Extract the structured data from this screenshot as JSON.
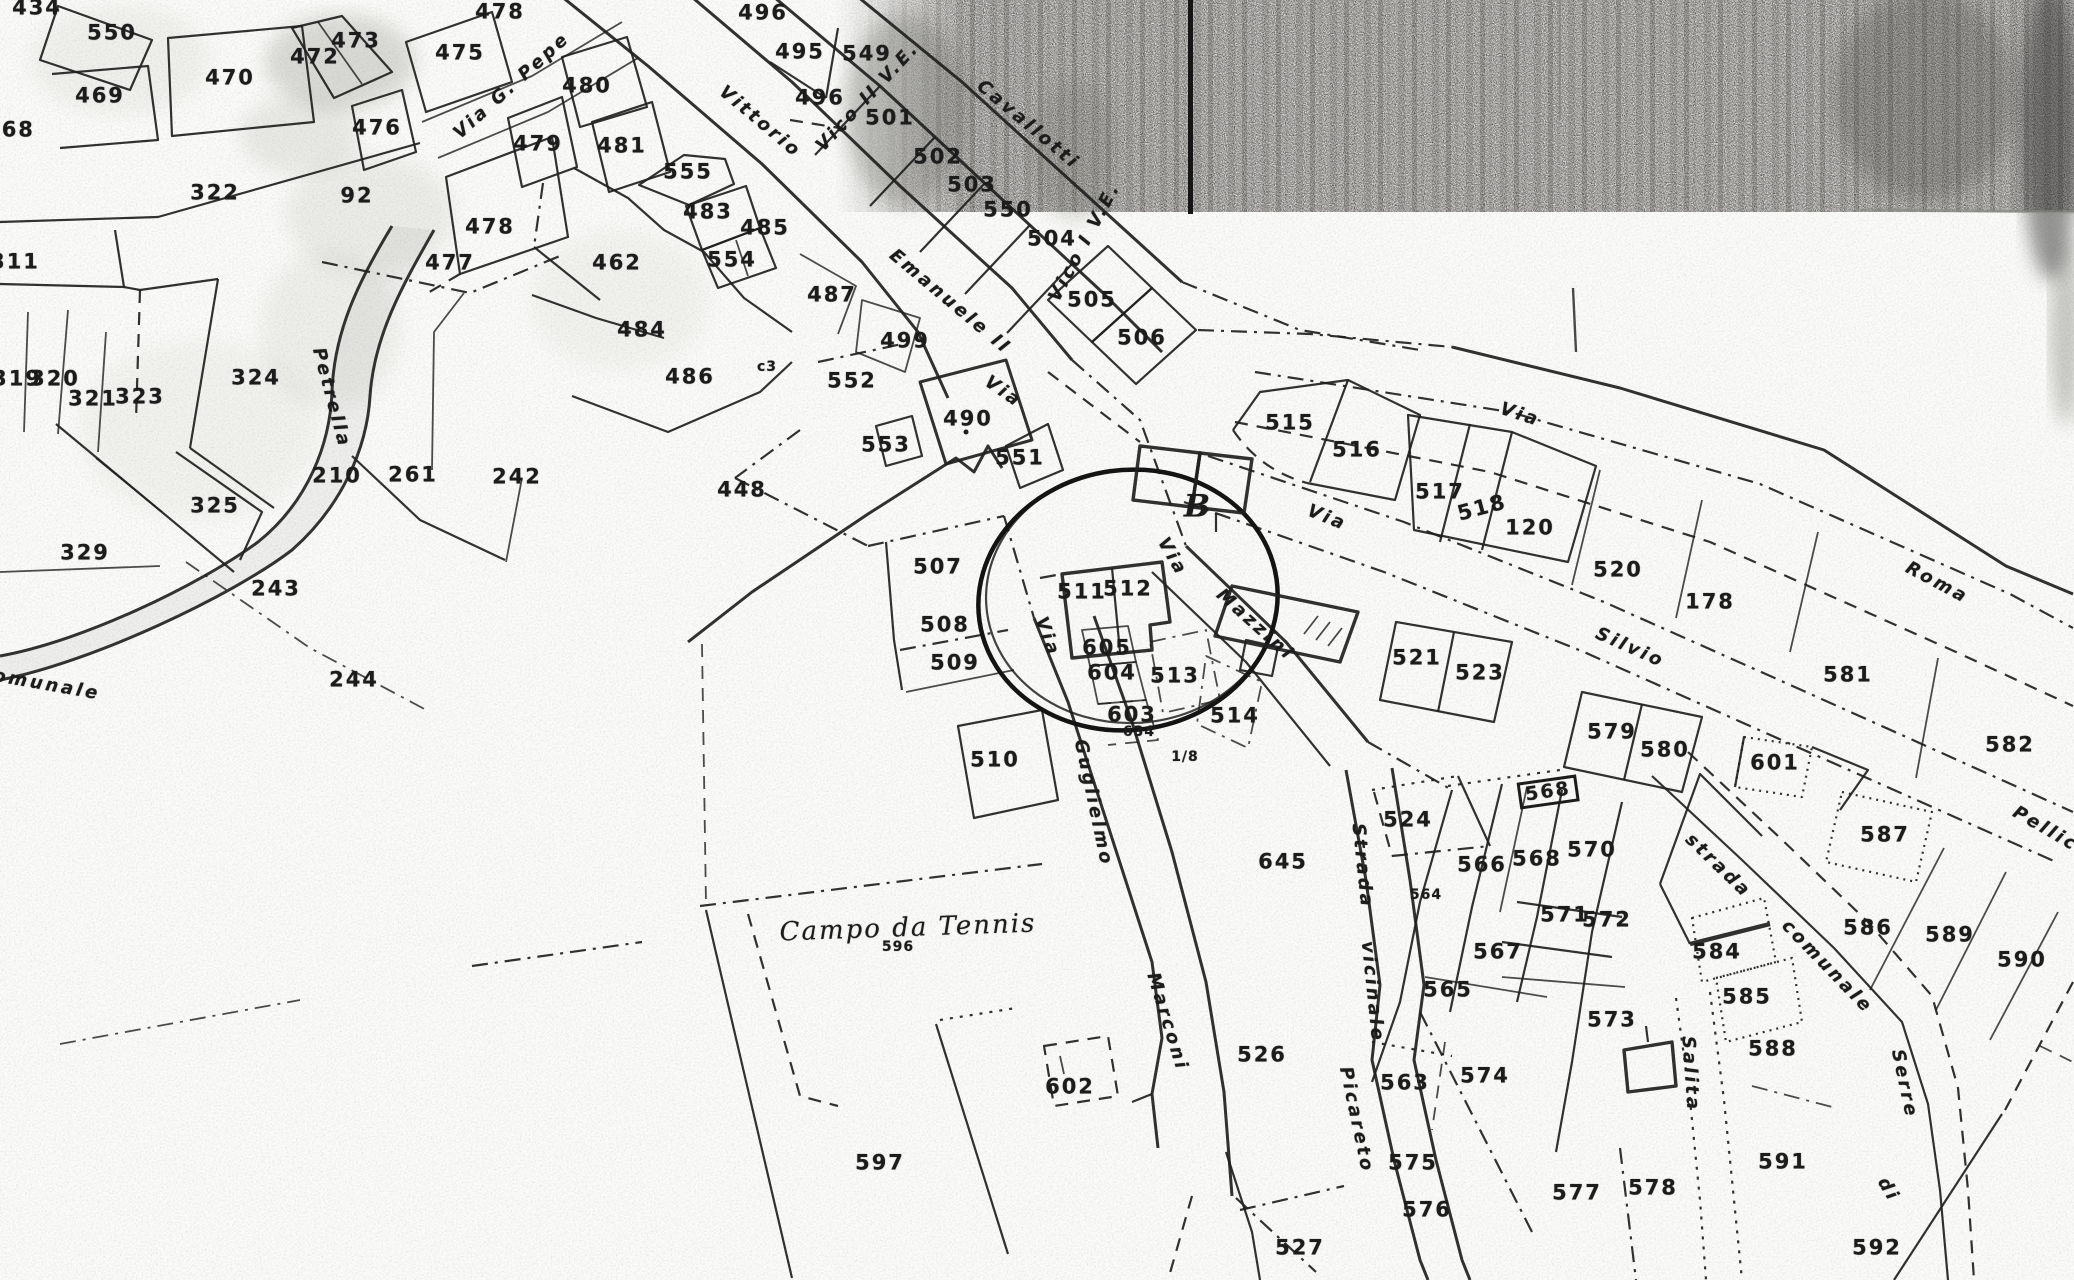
{
  "map": {
    "kind": "scanned-cadastral-map",
    "ink_color": "#1f1f1f",
    "paper_color": "#fbfbf9",
    "annotation_circle": {
      "cx": 1128,
      "cy": 600,
      "rx": 150,
      "ry": 130
    },
    "labels": [
      {
        "t": "434",
        "x": 37,
        "y": 8
      },
      {
        "t": "550",
        "x": 112,
        "y": 33
      },
      {
        "t": "469",
        "x": 100,
        "y": 96
      },
      {
        "t": "468",
        "x": 10,
        "y": 130
      },
      {
        "t": "470",
        "x": 230,
        "y": 78
      },
      {
        "t": "472",
        "x": 315,
        "y": 57
      },
      {
        "t": "473",
        "x": 356,
        "y": 41
      },
      {
        "t": "475",
        "x": 460,
        "y": 53
      },
      {
        "t": "478",
        "x": 500,
        "y": 12
      },
      {
        "t": "476",
        "x": 377,
        "y": 128
      },
      {
        "t": "479",
        "x": 538,
        "y": 144
      },
      {
        "t": "480",
        "x": 587,
        "y": 86
      },
      {
        "t": "481",
        "x": 622,
        "y": 146
      },
      {
        "t": "555",
        "x": 688,
        "y": 172
      },
      {
        "t": "483",
        "x": 708,
        "y": 212
      },
      {
        "t": "485",
        "x": 765,
        "y": 228
      },
      {
        "t": "554",
        "x": 732,
        "y": 260
      },
      {
        "t": "462",
        "x": 617,
        "y": 263
      },
      {
        "t": "478",
        "x": 490,
        "y": 227
      },
      {
        "t": "477",
        "x": 450,
        "y": 263
      },
      {
        "t": "484",
        "x": 642,
        "y": 330
      },
      {
        "t": "486",
        "x": 690,
        "y": 377
      },
      {
        "t": "487",
        "x": 832,
        "y": 295
      },
      {
        "t": "499",
        "x": 905,
        "y": 341
      },
      {
        "t": "c3",
        "x": 767,
        "y": 367,
        "k": "small"
      },
      {
        "t": "322",
        "x": 215,
        "y": 193
      },
      {
        "t": "92",
        "x": 357,
        "y": 196
      },
      {
        "t": "311",
        "x": 15,
        "y": 262
      },
      {
        "t": "319",
        "x": 17,
        "y": 379
      },
      {
        "t": "320",
        "x": 55,
        "y": 379
      },
      {
        "t": "321",
        "x": 93,
        "y": 399
      },
      {
        "t": "323",
        "x": 140,
        "y": 397
      },
      {
        "t": "324",
        "x": 256,
        "y": 378
      },
      {
        "t": "325",
        "x": 215,
        "y": 506
      },
      {
        "t": "329",
        "x": 85,
        "y": 553
      },
      {
        "t": "210",
        "x": 337,
        "y": 476
      },
      {
        "t": "261",
        "x": 413,
        "y": 475
      },
      {
        "t": "242",
        "x": 517,
        "y": 477
      },
      {
        "t": "243",
        "x": 276,
        "y": 589
      },
      {
        "t": "244",
        "x": 354,
        "y": 680
      },
      {
        "t": "496",
        "x": 763,
        "y": 13
      },
      {
        "t": "495",
        "x": 800,
        "y": 52
      },
      {
        "t": "549",
        "x": 867,
        "y": 54
      },
      {
        "t": "496",
        "x": 820,
        "y": 98
      },
      {
        "t": "501",
        "x": 890,
        "y": 118
      },
      {
        "t": "502",
        "x": 938,
        "y": 157
      },
      {
        "t": "503",
        "x": 972,
        "y": 185
      },
      {
        "t": "550",
        "x": 1008,
        "y": 210
      },
      {
        "t": "504",
        "x": 1052,
        "y": 239
      },
      {
        "t": "505",
        "x": 1092,
        "y": 300
      },
      {
        "t": "506",
        "x": 1142,
        "y": 338
      },
      {
        "t": "552",
        "x": 852,
        "y": 381
      },
      {
        "t": "553",
        "x": 886,
        "y": 445
      },
      {
        "t": "551",
        "x": 1020,
        "y": 458
      },
      {
        "t": "490",
        "x": 968,
        "y": 419
      },
      {
        "t": "448",
        "x": 742,
        "y": 490
      },
      {
        "t": "507",
        "x": 938,
        "y": 567
      },
      {
        "t": "508",
        "x": 945,
        "y": 625
      },
      {
        "t": "509",
        "x": 955,
        "y": 663
      },
      {
        "t": "510",
        "x": 995,
        "y": 760
      },
      {
        "t": "511",
        "x": 1082,
        "y": 592
      },
      {
        "t": "512",
        "x": 1128,
        "y": 589
      },
      {
        "t": "605",
        "x": 1107,
        "y": 648
      },
      {
        "t": "604",
        "x": 1112,
        "y": 673
      },
      {
        "t": "603",
        "x": 1132,
        "y": 715
      },
      {
        "t": "634",
        "x": 1139,
        "y": 732,
        "k": "small"
      },
      {
        "t": "513",
        "x": 1175,
        "y": 676
      },
      {
        "t": "514",
        "x": 1235,
        "y": 716
      },
      {
        "t": "1/8",
        "x": 1185,
        "y": 757,
        "k": "small"
      },
      {
        "t": "B",
        "x": 1198,
        "y": 507,
        "k": "letter"
      },
      {
        "t": "515",
        "x": 1290,
        "y": 423
      },
      {
        "t": "516",
        "x": 1357,
        "y": 450
      },
      {
        "t": "517",
        "x": 1440,
        "y": 492
      },
      {
        "t": "518",
        "x": 1482,
        "y": 508,
        "r": -15
      },
      {
        "t": "120",
        "x": 1530,
        "y": 528
      },
      {
        "t": "520",
        "x": 1618,
        "y": 570
      },
      {
        "t": "178",
        "x": 1710,
        "y": 602
      },
      {
        "t": "521",
        "x": 1417,
        "y": 658
      },
      {
        "t": "523",
        "x": 1480,
        "y": 673
      },
      {
        "t": "581",
        "x": 1848,
        "y": 675
      },
      {
        "t": "582",
        "x": 2010,
        "y": 745
      },
      {
        "t": "579",
        "x": 1612,
        "y": 732
      },
      {
        "t": "580",
        "x": 1665,
        "y": 750
      },
      {
        "t": "601",
        "x": 1775,
        "y": 763
      },
      {
        "t": "587",
        "x": 1885,
        "y": 835
      },
      {
        "t": "586",
        "x": 1868,
        "y": 928
      },
      {
        "t": "589",
        "x": 1950,
        "y": 935
      },
      {
        "t": "590",
        "x": 2022,
        "y": 960
      },
      {
        "t": "588",
        "x": 1773,
        "y": 1049
      },
      {
        "t": "591",
        "x": 1783,
        "y": 1162
      },
      {
        "t": "592",
        "x": 1877,
        "y": 1248
      },
      {
        "t": "584",
        "x": 1717,
        "y": 952
      },
      {
        "t": "585",
        "x": 1747,
        "y": 997
      },
      {
        "t": "524",
        "x": 1408,
        "y": 820
      },
      {
        "t": "645",
        "x": 1283,
        "y": 862
      },
      {
        "t": "566",
        "x": 1482,
        "y": 865
      },
      {
        "t": "568",
        "x": 1537,
        "y": 859
      },
      {
        "t": "570",
        "x": 1592,
        "y": 850
      },
      {
        "t": "568",
        "x": 1548,
        "y": 792,
        "k": "boxed",
        "r": -8
      },
      {
        "t": "564",
        "x": 1426,
        "y": 895,
        "k": "small"
      },
      {
        "t": "571",
        "x": 1565,
        "y": 915
      },
      {
        "t": "572",
        "x": 1607,
        "y": 920
      },
      {
        "t": "567",
        "x": 1498,
        "y": 952
      },
      {
        "t": "565",
        "x": 1448,
        "y": 990
      },
      {
        "t": "573",
        "x": 1612,
        "y": 1020
      },
      {
        "t": "563",
        "x": 1405,
        "y": 1083
      },
      {
        "t": "574",
        "x": 1485,
        "y": 1076
      },
      {
        "t": "575",
        "x": 1413,
        "y": 1163
      },
      {
        "t": "576",
        "x": 1427,
        "y": 1210
      },
      {
        "t": "577",
        "x": 1577,
        "y": 1193
      },
      {
        "t": "578",
        "x": 1653,
        "y": 1188
      },
      {
        "t": "526",
        "x": 1262,
        "y": 1055
      },
      {
        "t": "527",
        "x": 1300,
        "y": 1248
      },
      {
        "t": "602",
        "x": 1070,
        "y": 1087
      },
      {
        "t": "597",
        "x": 880,
        "y": 1163
      },
      {
        "t": "596",
        "x": 898,
        "y": 947,
        "k": "small"
      },
      {
        "t": "Campo da Tennis",
        "x": 908,
        "y": 928,
        "r": -2,
        "k": "script"
      },
      {
        "t": "Vittorio",
        "x": 760,
        "y": 122,
        "r": 40,
        "k": "street"
      },
      {
        "t": "Emanuele II",
        "x": 950,
        "y": 302,
        "r": 40,
        "k": "street"
      },
      {
        "t": "Via G. Pepe",
        "x": 512,
        "y": 86,
        "r": -42,
        "k": "street"
      },
      {
        "t": "Vico II V.E.",
        "x": 868,
        "y": 97,
        "r": -47,
        "k": "street"
      },
      {
        "t": "Cavallotti",
        "x": 1028,
        "y": 125,
        "r": 40,
        "k": "street"
      },
      {
        "t": "Vico I V.E.",
        "x": 1085,
        "y": 242,
        "r": -62,
        "k": "street"
      },
      {
        "t": "Via",
        "x": 1003,
        "y": 392,
        "r": 35,
        "k": "street"
      },
      {
        "t": "Via",
        "x": 1520,
        "y": 415,
        "r": 18,
        "k": "street"
      },
      {
        "t": "Roma",
        "x": 1937,
        "y": 583,
        "r": 28,
        "k": "street"
      },
      {
        "t": "Via",
        "x": 1327,
        "y": 518,
        "r": 22,
        "k": "street"
      },
      {
        "t": "Silvio",
        "x": 1630,
        "y": 648,
        "r": 24,
        "k": "street"
      },
      {
        "t": "Pellico",
        "x": 2052,
        "y": 833,
        "r": 30,
        "k": "street"
      },
      {
        "t": "Via",
        "x": 1172,
        "y": 557,
        "r": 60,
        "k": "street"
      },
      {
        "t": "Mazzini",
        "x": 1255,
        "y": 625,
        "r": 42,
        "k": "street"
      },
      {
        "t": "Via",
        "x": 1047,
        "y": 637,
        "r": 70,
        "k": "street"
      },
      {
        "t": "Guglielmo",
        "x": 1093,
        "y": 803,
        "r": 78,
        "k": "street"
      },
      {
        "t": "Marconi",
        "x": 1167,
        "y": 1022,
        "r": 73,
        "k": "street"
      },
      {
        "t": "Strada",
        "x": 1362,
        "y": 866,
        "r": 84,
        "k": "street"
      },
      {
        "t": "vicinale",
        "x": 1372,
        "y": 992,
        "r": 84,
        "k": "street"
      },
      {
        "t": "Picareto",
        "x": 1356,
        "y": 1120,
        "r": 78,
        "k": "street"
      },
      {
        "t": "Salita",
        "x": 1690,
        "y": 1074,
        "r": 86,
        "k": "street"
      },
      {
        "t": "strada",
        "x": 1718,
        "y": 866,
        "r": 44,
        "k": "street"
      },
      {
        "t": "comunale",
        "x": 1827,
        "y": 967,
        "r": 46,
        "k": "street"
      },
      {
        "t": "Serre",
        "x": 1904,
        "y": 1084,
        "r": 78,
        "k": "street"
      },
      {
        "t": "di",
        "x": 1888,
        "y": 1190,
        "r": 60,
        "k": "street"
      },
      {
        "t": "Petrella",
        "x": 331,
        "y": 398,
        "r": 75,
        "k": "street"
      },
      {
        "t": "comunale",
        "x": 40,
        "y": 684,
        "r": 10,
        "k": "street"
      }
    ]
  }
}
